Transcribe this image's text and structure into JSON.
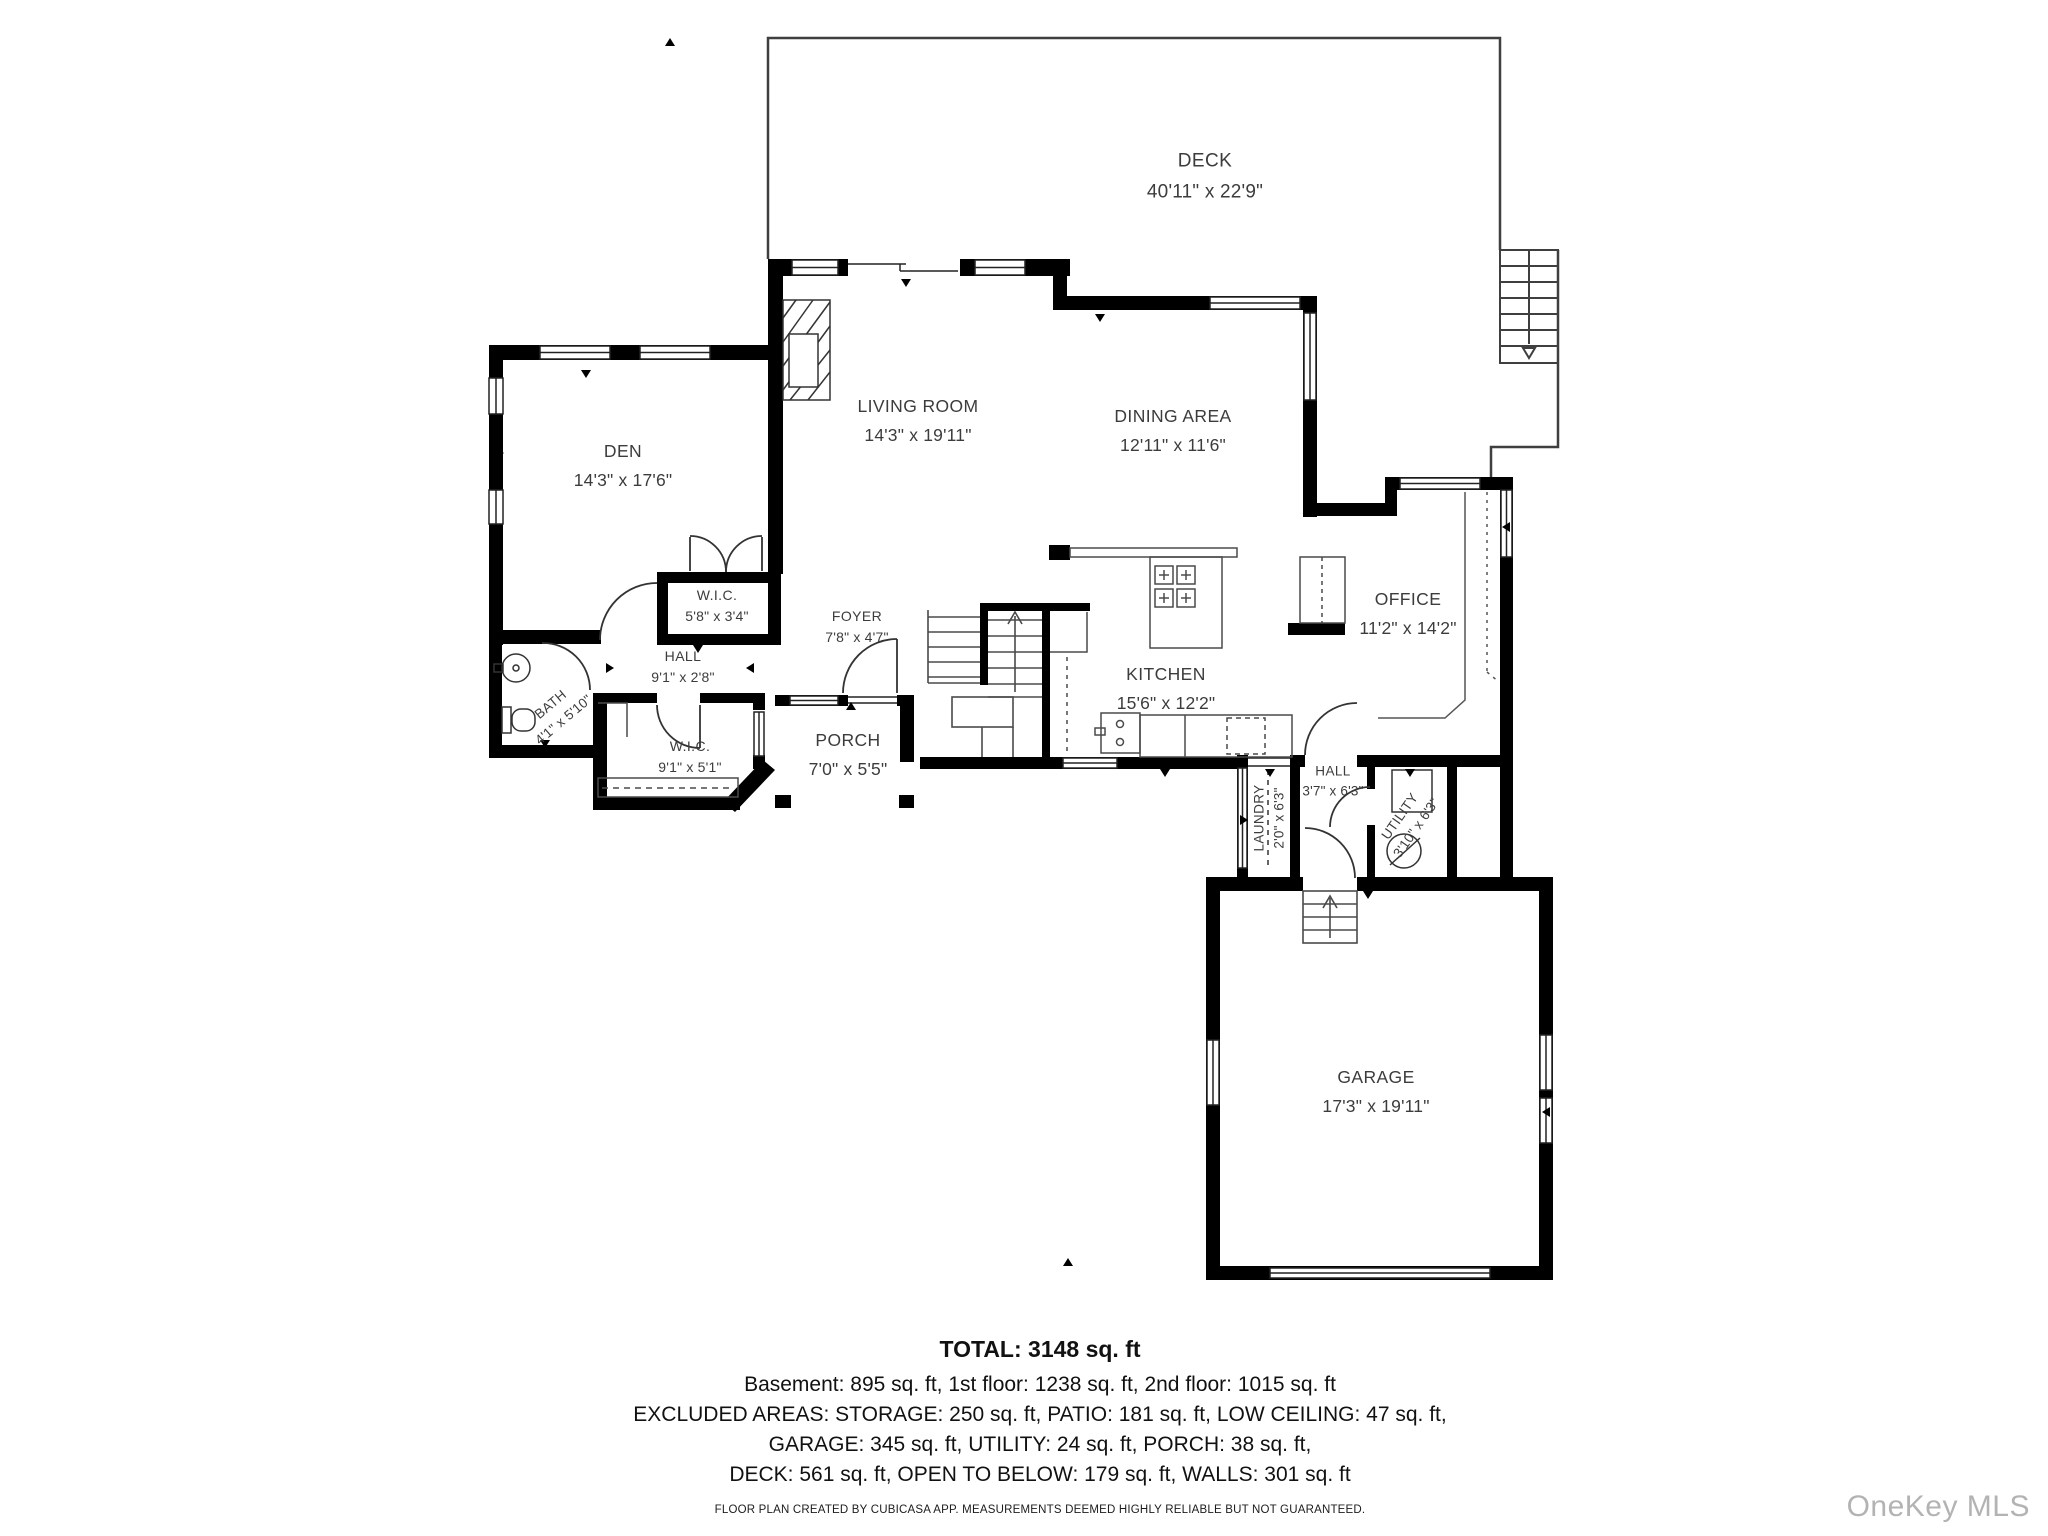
{
  "rooms": {
    "deck": {
      "name": "DECK",
      "dims": "40'11\" x 22'9\""
    },
    "den": {
      "name": "DEN",
      "dims": "14'3\" x 17'6\""
    },
    "living": {
      "name": "LIVING ROOM",
      "dims": "14'3\" x 19'11\""
    },
    "dining": {
      "name": "DINING AREA",
      "dims": "12'11\" x 11'6\""
    },
    "wic_upper": {
      "name": "W.I.C.",
      "dims": "5'8\" x 3'4\""
    },
    "hall_main": {
      "name": "HALL",
      "dims": "9'1\" x 2'8\""
    },
    "foyer": {
      "name": "FOYER",
      "dims": "7'8\" x 4'7\""
    },
    "bath": {
      "name": "BATH",
      "dims": "4'1\" x 5'10\""
    },
    "wic_lower": {
      "name": "W.I.C.",
      "dims": "9'1\" x 5'1\""
    },
    "porch": {
      "name": "PORCH",
      "dims": "7'0\" x 5'5\""
    },
    "kitchen": {
      "name": "KITCHEN",
      "dims": "15'6\" x 12'2\""
    },
    "office": {
      "name": "OFFICE",
      "dims": "11'2\" x 14'2\""
    },
    "laundry": {
      "name": "LAUNDRY",
      "dims": "2'0\" x 6'3\""
    },
    "hall_small": {
      "name": "HALL",
      "dims": "3'7\" x 6'3\""
    },
    "utility": {
      "name": "UTILITY",
      "dims": "3'10\" x 6'3\""
    },
    "garage": {
      "name": "GARAGE",
      "dims": "17'3\" x 19'11\""
    }
  },
  "summary": {
    "total": "TOTAL: 3148 sq. ft",
    "line1": "Basement: 895 sq. ft, 1st floor: 1238 sq. ft, 2nd floor: 1015 sq. ft",
    "line2": "EXCLUDED AREAS: STORAGE: 250 sq. ft, PATIO: 181 sq. ft, LOW CEILING: 47 sq. ft,",
    "line3": "GARAGE: 345 sq. ft, UTILITY: 24 sq. ft, PORCH: 38 sq. ft,",
    "line4": "DECK: 561 sq. ft, OPEN TO BELOW: 179 sq. ft, WALLS: 301 sq. ft"
  },
  "footer": {
    "disclaimer": "FLOOR PLAN CREATED BY CUBICASA APP. MEASUREMENTS DEEMED HIGHLY RELIABLE BUT NOT GUARANTEED."
  },
  "watermark": {
    "text": "OneKey MLS"
  },
  "colors": {
    "wall": "#000000",
    "thin_line": "#4a4a4a",
    "text": "#3c3c3c",
    "watermark": "#b3b3b3"
  }
}
